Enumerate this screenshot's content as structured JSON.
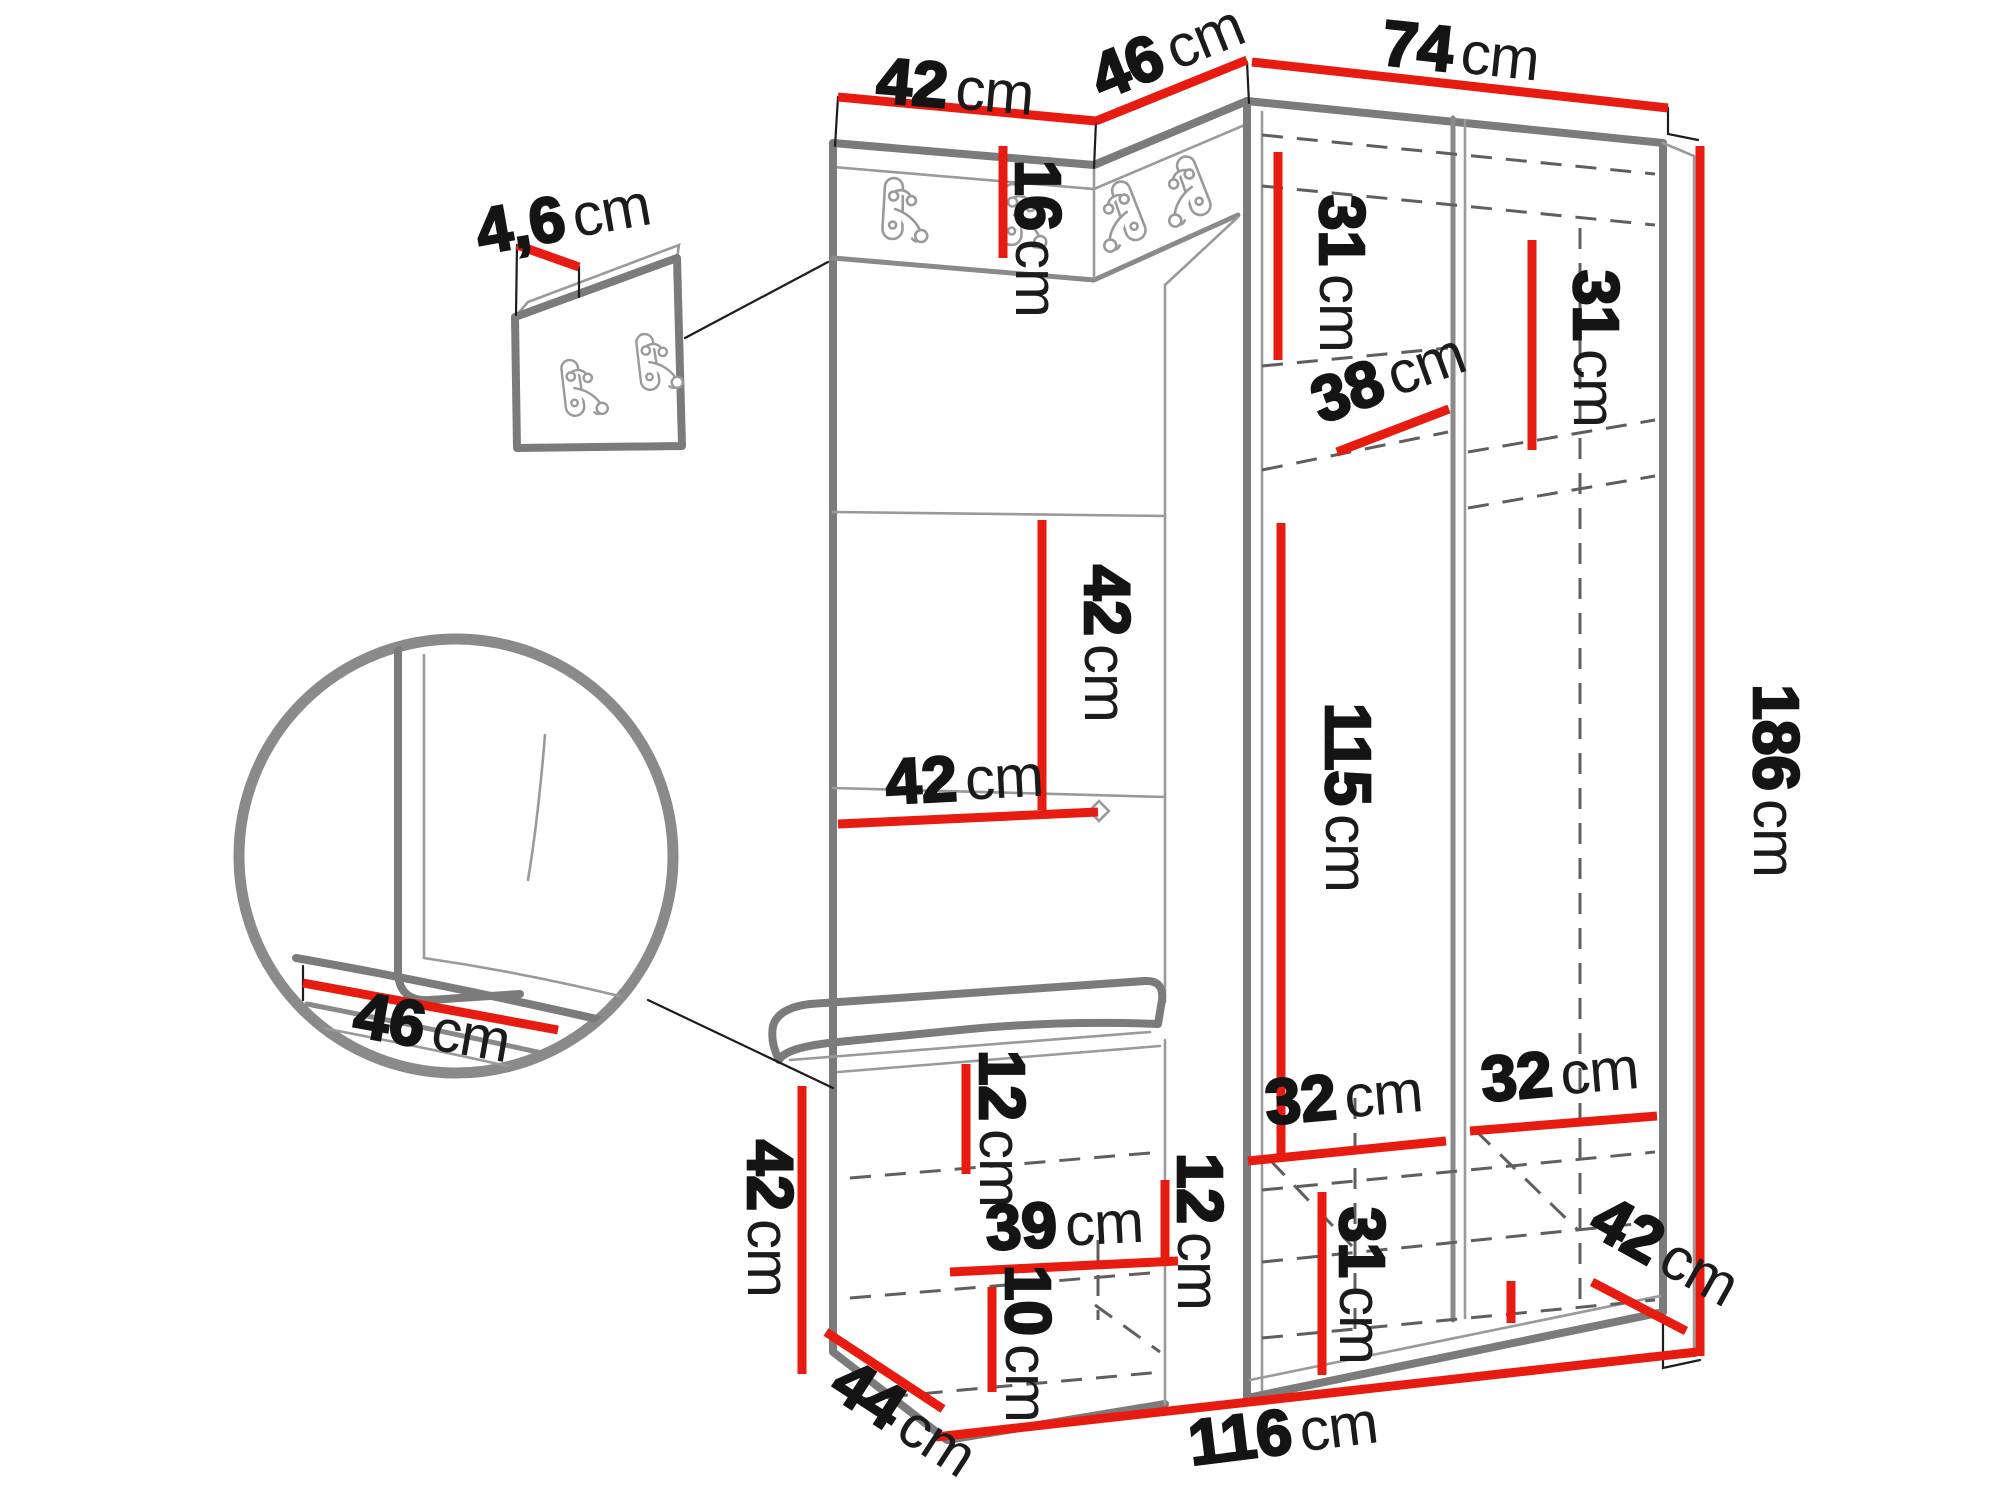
{
  "diagram": {
    "kind": "furniture-dimension-diagram",
    "unit": "cm"
  },
  "colors": {
    "dimension_line": "#e81b10",
    "furniture_line": "#7b7b7b",
    "label_text": "#141414",
    "background": "#ffffff"
  },
  "icons": {
    "coat_hook": "double-prong-coat-hook",
    "magnifier": "detail-zoom-circle"
  },
  "dimensions": {
    "top_left_width": {
      "value": "42",
      "unit": "cm"
    },
    "corner_width": {
      "value": "46",
      "unit": "cm"
    },
    "wardrobe_width": {
      "value": "74",
      "unit": "cm"
    },
    "panel_thickness": {
      "value": "4,6",
      "unit": "cm"
    },
    "hook_strip_height": {
      "value": "16",
      "unit": "cm"
    },
    "left_top_height": {
      "value": "31",
      "unit": "cm"
    },
    "right_top_height": {
      "value": "31",
      "unit": "cm"
    },
    "shelf_depth": {
      "value": "38",
      "unit": "cm"
    },
    "panel_tile_height": {
      "value": "42",
      "unit": "cm"
    },
    "panel_tile_width": {
      "value": "42",
      "unit": "cm"
    },
    "hanging_space_height": {
      "value": "115",
      "unit": "cm"
    },
    "total_height": {
      "value": "186",
      "unit": "cm"
    },
    "seat_depth": {
      "value": "46",
      "unit": "cm"
    },
    "bench_height": {
      "value": "42",
      "unit": "cm"
    },
    "seat_gap_height": {
      "value": "12",
      "unit": "cm"
    },
    "bench_shelf_width": {
      "value": "39",
      "unit": "cm"
    },
    "bench_side_gap_height": {
      "value": "12",
      "unit": "cm"
    },
    "bench_bottom_height": {
      "value": "10",
      "unit": "cm"
    },
    "bench_depth": {
      "value": "44",
      "unit": "cm"
    },
    "left_shelf_width": {
      "value": "32",
      "unit": "cm"
    },
    "right_shelf_width": {
      "value": "32",
      "unit": "cm"
    },
    "bottom_section_height": {
      "value": "31",
      "unit": "cm"
    },
    "wardrobe_depth": {
      "value": "42",
      "unit": "cm"
    },
    "total_width": {
      "value": "116",
      "unit": "cm"
    }
  }
}
